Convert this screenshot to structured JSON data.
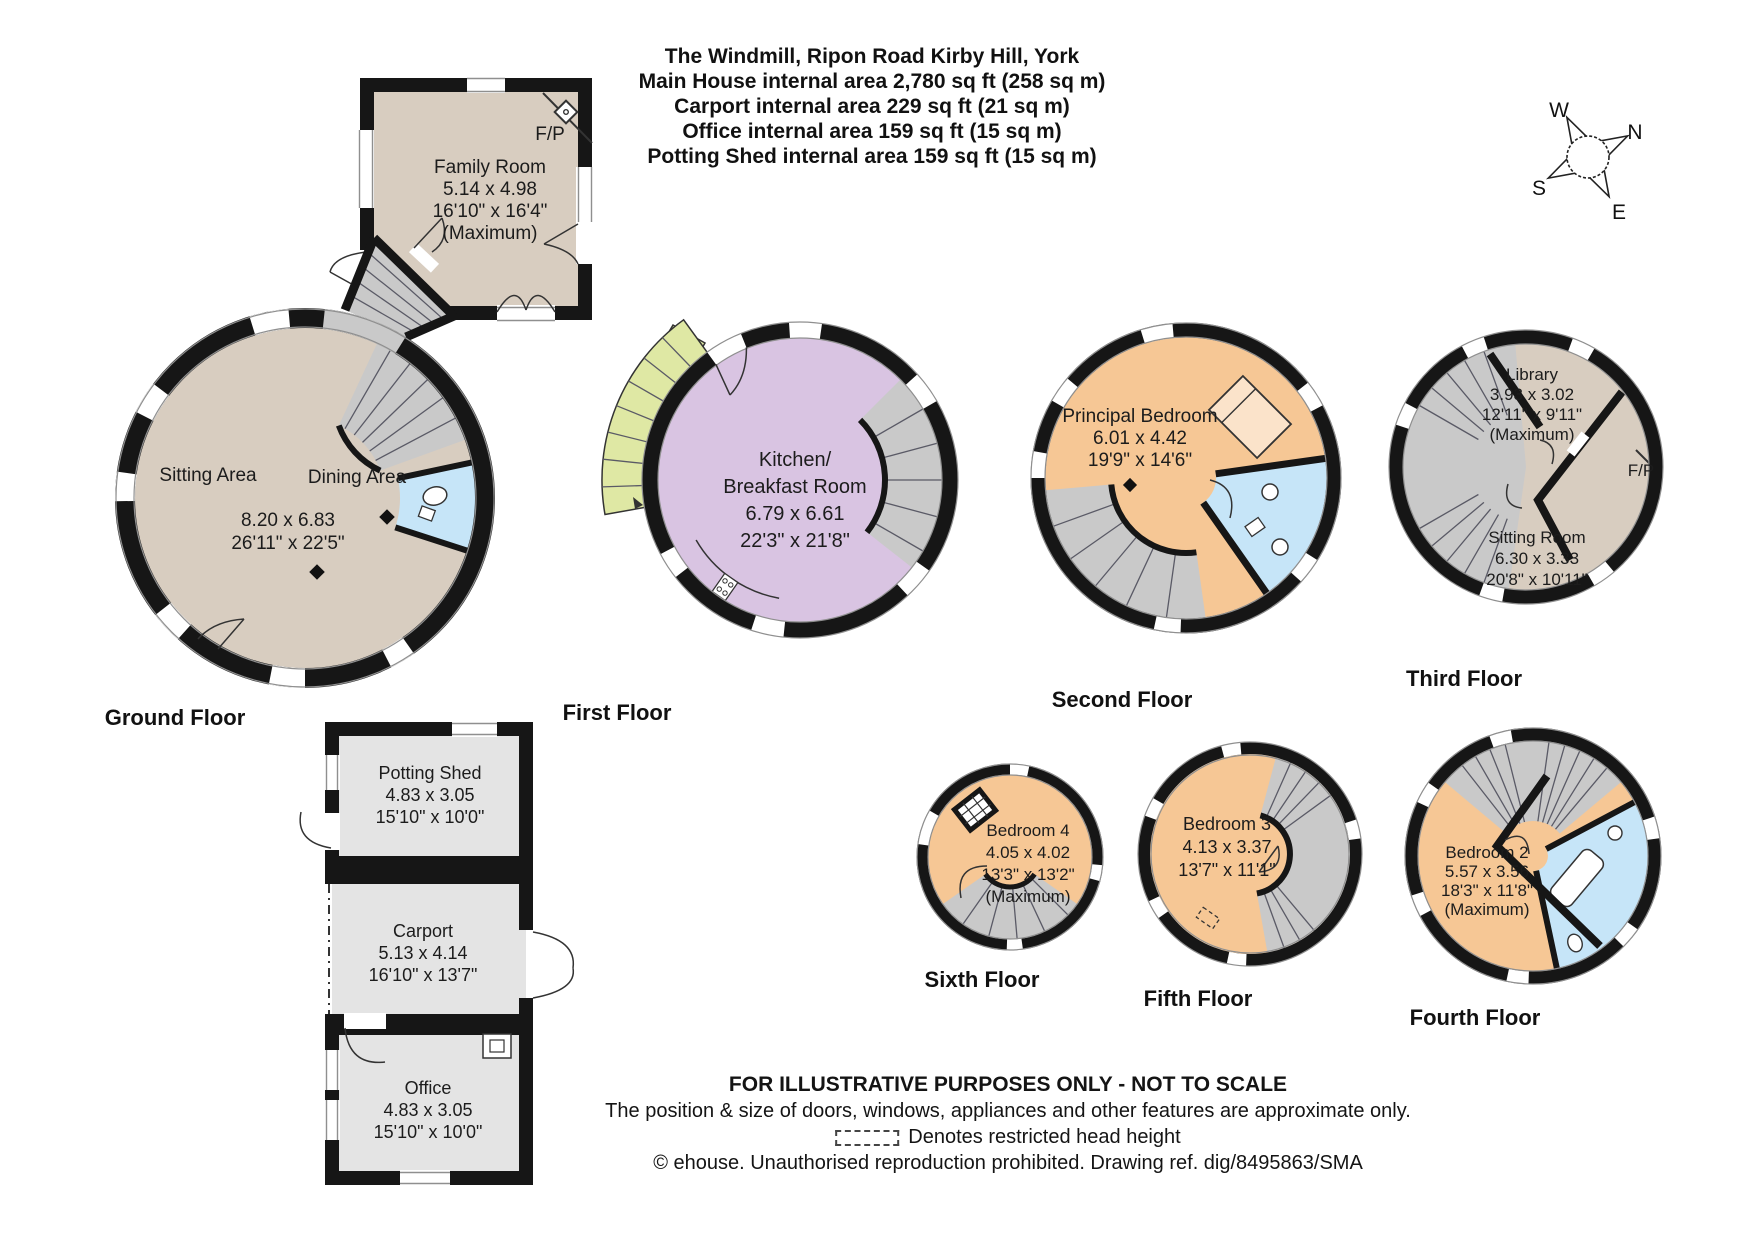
{
  "title": {
    "lines": [
      "The Windmill, Ripon Road Kirby Hill, York",
      "Main House internal area 2,780 sq ft (258 sq m)",
      "Carport internal area 229 sq ft (21 sq m)",
      "Office internal area 159 sq ft (15 sq m)",
      "Potting Shed internal area 159 sq ft (15 sq m)"
    ]
  },
  "compass": {
    "north": "N",
    "east": "E",
    "south": "S",
    "west": "W"
  },
  "floors": {
    "family_room": {
      "name": "Family Room",
      "dims_m": "5.14 x 4.98",
      "dims_ft": "16'10\" x 16'4\"",
      "note": "(Maximum)",
      "fireplace": "F/P"
    },
    "ground": {
      "label": "Ground Floor",
      "sitting_area": "Sitting Area",
      "dining_area": "Dining Area",
      "dims_m": "8.20 x 6.83",
      "dims_ft": "26'11\" x 22'5\""
    },
    "first": {
      "label": "First Floor",
      "name_line1": "Kitchen/",
      "name_line2": "Breakfast Room",
      "dims_m": "6.79 x 6.61",
      "dims_ft": "22'3\" x 21'8\""
    },
    "second": {
      "label": "Second Floor",
      "name": "Principal Bedroom",
      "dims_m": "6.01 x 4.42",
      "dims_ft": "19'9\" x 14'6\""
    },
    "third": {
      "label": "Third Floor",
      "library": {
        "name": "Library",
        "dims_m": "3.93 x 3.02",
        "dims_ft": "12'11\" x 9'11\"",
        "note": "(Maximum)"
      },
      "fireplace": "F/P",
      "sitting_room": {
        "name": "Sitting Room",
        "dims_m": "6.30 x 3.33",
        "dims_ft": "20'8\" x 10'11\""
      }
    },
    "fourth": {
      "label": "Fourth Floor",
      "name": "Bedroom 2",
      "dims_m": "5.57 x 3.56",
      "dims_ft": "18'3\" x 11'8\"",
      "note": "(Maximum)"
    },
    "fifth": {
      "label": "Fifth Floor",
      "name": "Bedroom 3",
      "dims_m": "4.13 x 3.37",
      "dims_ft": "13'7\" x 11'1\""
    },
    "sixth": {
      "label": "Sixth Floor",
      "name": "Bedroom 4",
      "dims_m": "4.05 x 4.02",
      "dims_ft": "13'3\" x 13'2\"",
      "note": "(Maximum)"
    }
  },
  "outbuildings": {
    "potting_shed": {
      "name": "Potting Shed",
      "dims_m": "4.83 x 3.05",
      "dims_ft": "15'10\" x 10'0\""
    },
    "carport": {
      "name": "Carport",
      "dims_m": "5.13 x 4.14",
      "dims_ft": "16'10\" x 13'7\""
    },
    "office": {
      "name": "Office",
      "dims_m": "4.83 x 3.05",
      "dims_ft": "15'10\" x 10'0\""
    }
  },
  "footer": {
    "line1": "FOR ILLUSTRATIVE PURPOSES ONLY - NOT TO SCALE",
    "line2": "The position & size of doors, windows, appliances and other features are approximate only.",
    "line3": "Denotes restricted head height",
    "line4": "© ehouse. Unauthorised reproduction prohibited. Drawing ref. dig/8495863/SMA"
  },
  "colors": {
    "wall": "#161616",
    "beige": "#d8cdc0",
    "lavender": "#d9c4e2",
    "peach": "#f6c795",
    "bath_blue": "#c6e5f8",
    "stair_gray": "#c9c9c9",
    "outbuilding_gray": "#e4e4e4",
    "external_stair_green": "#dfe8a4",
    "text": "#1c1c1c"
  }
}
